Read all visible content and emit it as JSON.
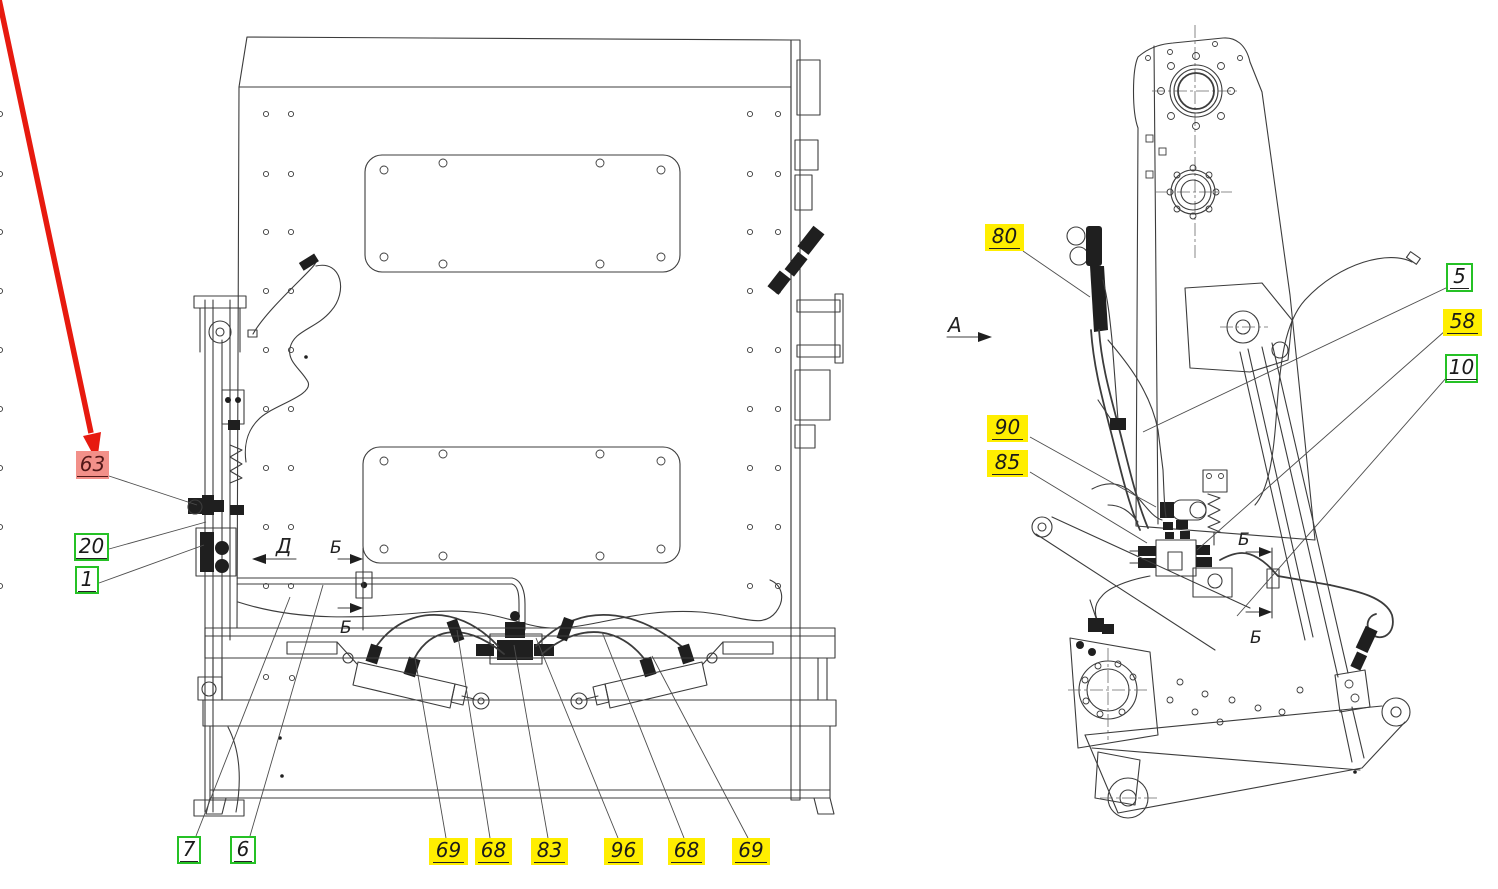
{
  "diagram": {
    "kind": "hydraulic-equipment-parts-diagram",
    "views": {
      "left_view_name": "rear elevation with hydraulic cylinders",
      "right_view_name": "side elevation of mast and bucket frame"
    }
  },
  "view_markers": {
    "a": "А",
    "d": "Д",
    "b": "Б"
  },
  "callouts": {
    "n63": "63",
    "n20": "20",
    "n1": "1",
    "n7": "7",
    "n6": "6",
    "n69a": "69",
    "n68a": "68",
    "n83": "83",
    "n96": "96",
    "n68b": "68",
    "n69b": "69",
    "n80": "80",
    "n5": "5",
    "n58": "58",
    "n10": "10",
    "n90": "90",
    "n85": "85"
  },
  "colors": {
    "selected_highlight": "#f29089",
    "related_highlight": "#ffee00",
    "plain_box_border": "#25c125",
    "pointer_arrow": "#e71a0f",
    "line_art": "#3c3c3c"
  }
}
